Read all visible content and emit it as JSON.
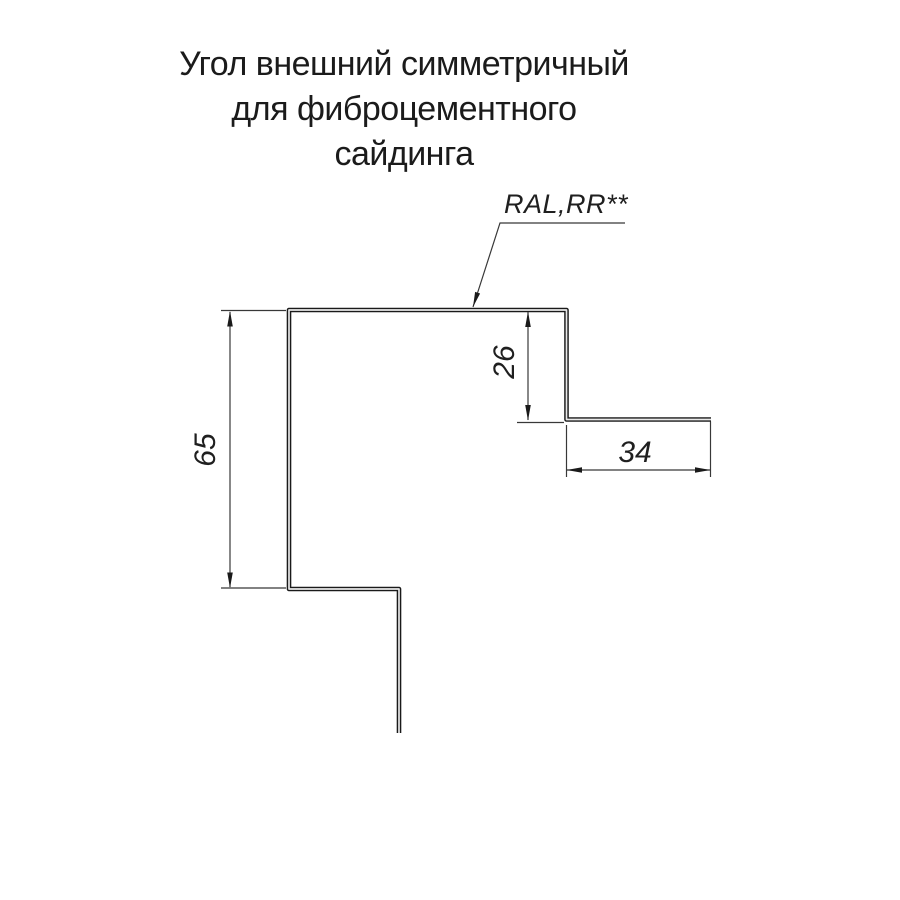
{
  "title": {
    "line1": "Угол внешний симметричный",
    "line2": "для фиброцементного",
    "line3": "сайдинга"
  },
  "drawing": {
    "coating_label": "RAL,RR**",
    "dimensions": {
      "left_height": "65",
      "right_step_height": "26",
      "right_flange_width": "34"
    },
    "colors": {
      "profile_line": "#1a1a1a",
      "thin_line": "#383838",
      "text": "#1b1b1b",
      "background": "#ffffff"
    }
  }
}
